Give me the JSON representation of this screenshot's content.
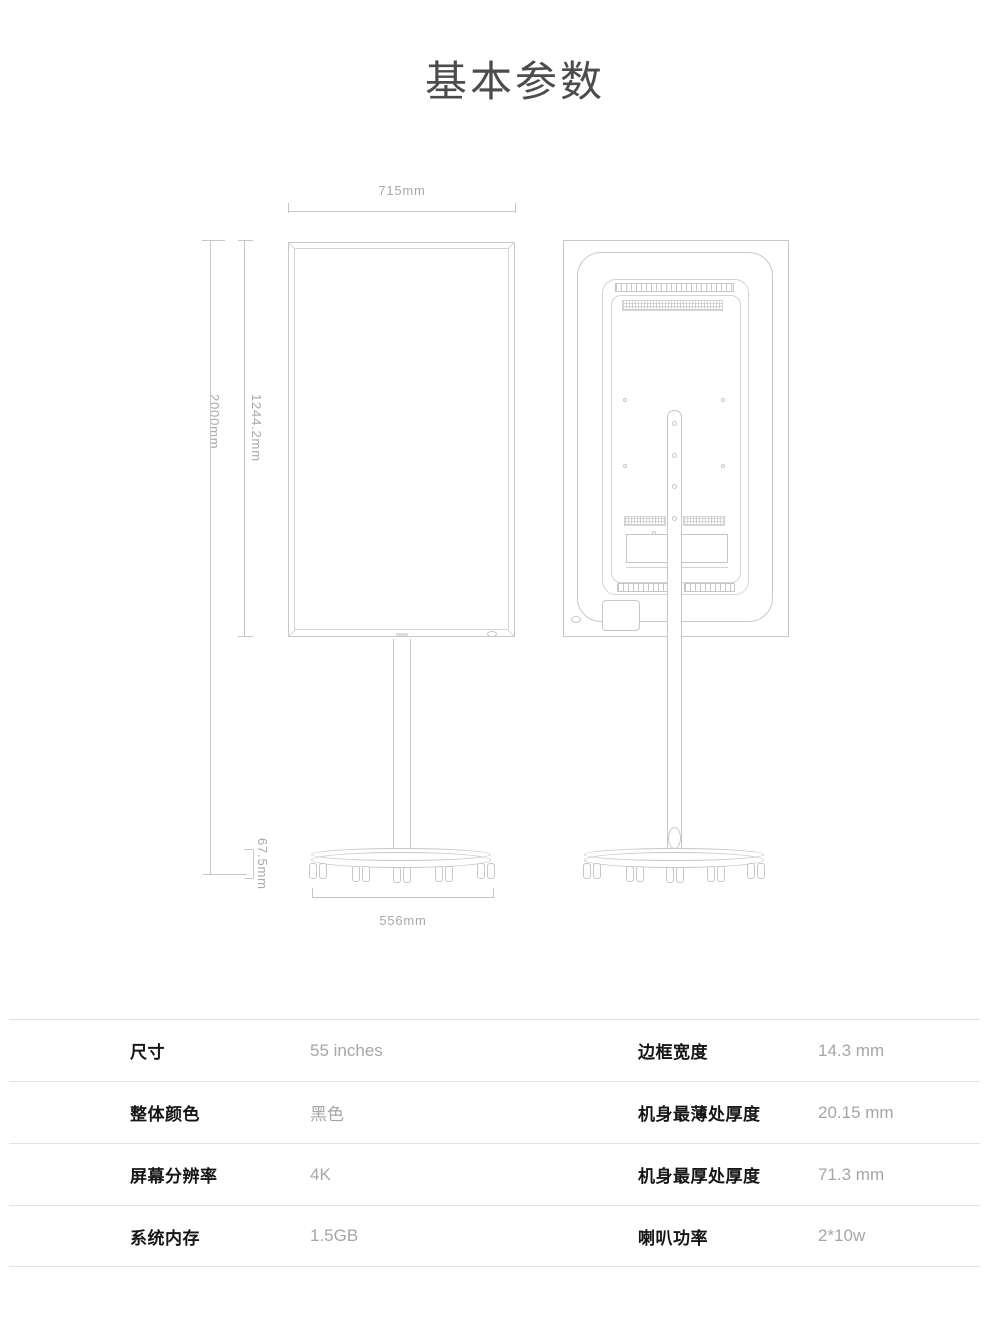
{
  "page": {
    "title": "基本参数"
  },
  "diagram": {
    "dimensions": {
      "top_width": "715mm",
      "total_height": "2000mm",
      "screen_height": "1244.2mm",
      "base_height": "67.5mm",
      "base_width": "556mm"
    }
  },
  "spec_table": {
    "rows": [
      {
        "label1": "尺寸",
        "value1": "55 inches",
        "label2": "边框宽度",
        "value2": "14.3 mm"
      },
      {
        "label1": "整体颜色",
        "value1": "黑色",
        "label2": "机身最薄处厚度",
        "value2": "20.15 mm"
      },
      {
        "label1": "屏幕分辨率",
        "value1": "4K",
        "label2": "机身最厚处厚度",
        "value2": "71.3 mm"
      },
      {
        "label1": "系统内存",
        "value1": "1.5GB",
        "label2": "喇叭功率",
        "value2": "2*10w"
      }
    ]
  },
  "colors": {
    "drawing_line": "#c7c7c7",
    "dimension_text": "#a8a8a8",
    "title_text": "#4c4c4c",
    "table_label_text": "#161616",
    "table_value_text": "#a6a6a6",
    "divider": "#e3e3e3"
  }
}
